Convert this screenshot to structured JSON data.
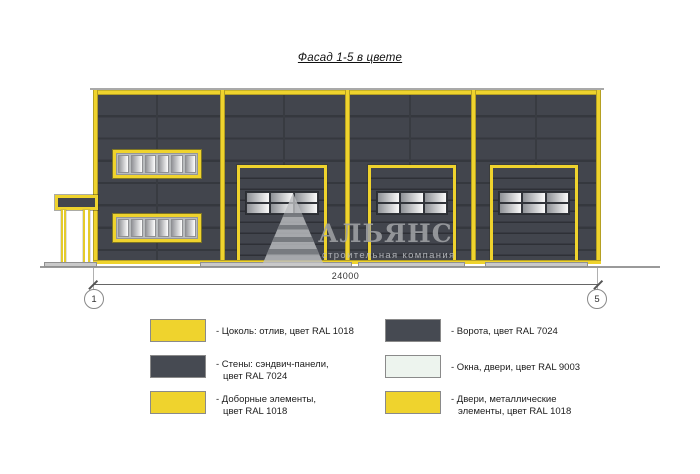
{
  "sheet": {
    "title": "Фасад 1-5 в цвете"
  },
  "watermark": {
    "name": "АЛЬЯНС",
    "subtitle": "строительная компания"
  },
  "dimension": {
    "total_length": "24000",
    "axis_left": "1",
    "axis_right": "5"
  },
  "palette": {
    "accent_yellow_ral_1018": "#efd32d",
    "wall_dark_ral_7024": "#42454d",
    "white_ral_9003": "#edf4ee",
    "ground_gray": "#9a9a9a"
  },
  "legend": {
    "items": [
      {
        "color": "#efd32d",
        "line1": "- Цоколь: отлив, цвет RAL 1018",
        "line2": ""
      },
      {
        "color": "#464a52",
        "line1": "- Стены: сэндвич-панели,",
        "line2": "цвет RAL 7024"
      },
      {
        "color": "#efd32d",
        "line1": "- Доборные элементы,",
        "line2": "цвет RAL 1018"
      },
      {
        "color": "#464a52",
        "line1": "- Ворота, цвет RAL 7024",
        "line2": ""
      },
      {
        "color": "#edf4ee",
        "line1": "- Окна, двери, цвет RAL 9003",
        "line2": ""
      },
      {
        "color": "#efd32d",
        "line1": "- Двери, металлические",
        "line2": "элементы, цвет RAL 1018"
      }
    ]
  }
}
